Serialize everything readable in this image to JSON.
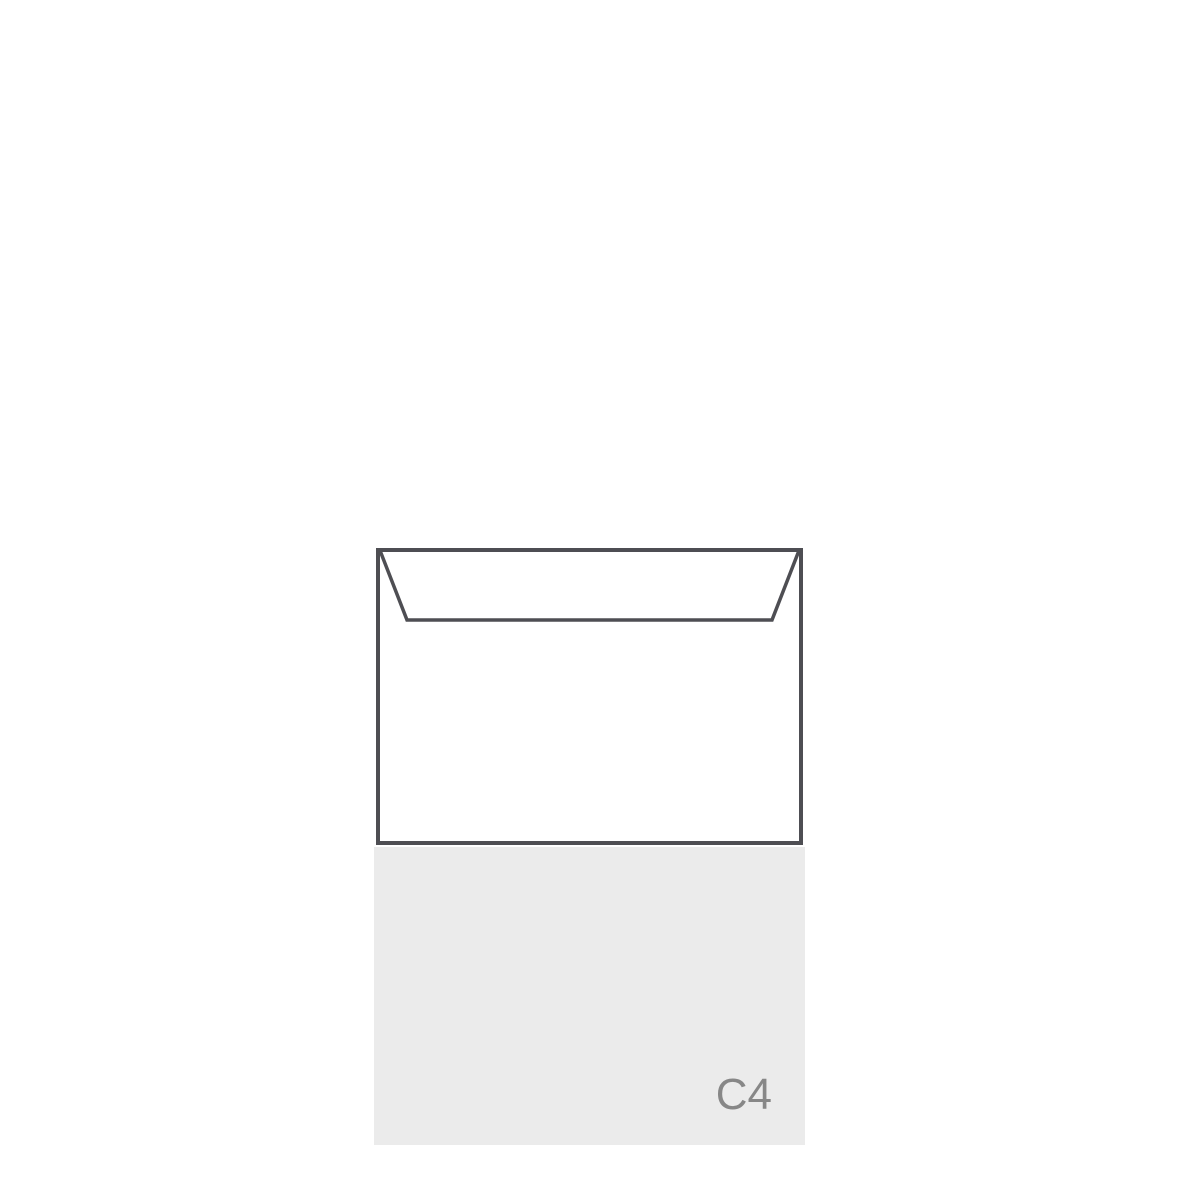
{
  "illustration": {
    "format_label": "C4"
  },
  "colors": {
    "background": "#ffffff",
    "envelope-outline": "#4e4e53",
    "envelope-fill": "#ffffff",
    "panel-bg": "#ebebeb",
    "label-color": "#878787"
  }
}
